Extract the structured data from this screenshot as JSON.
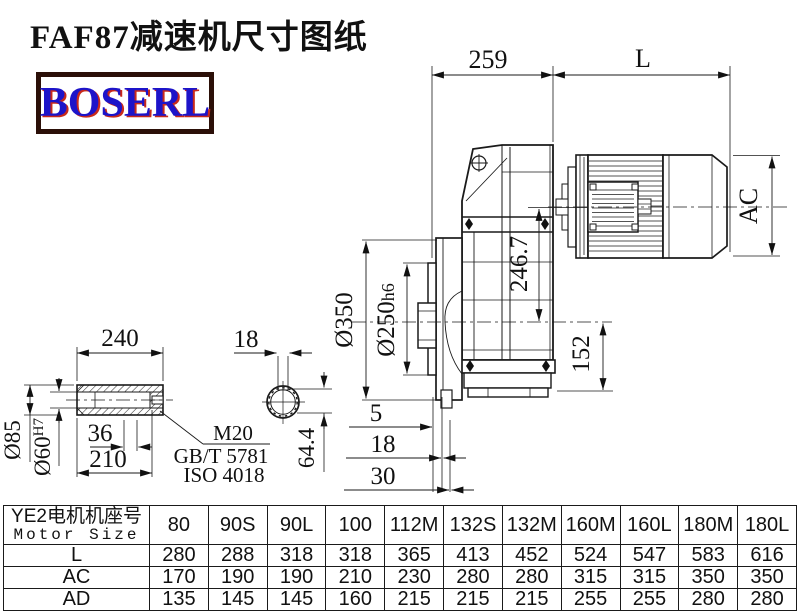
{
  "title": "FAF87减速机尺寸图纸",
  "logo": {
    "text": "BOSERL"
  },
  "drawing": {
    "dims": {
      "top_width": "259",
      "motor_length": "L",
      "motor_diameter": "AC",
      "center_height": "246.7",
      "flange_od": "Ø350",
      "spigot_d": "Ø250",
      "spigot_tol": "h6",
      "below_center": "152",
      "offset_5": "5",
      "offset_18": "18",
      "offset_30": "30",
      "sleeve_length": "240",
      "sleeve_od": "Ø85",
      "bore_d": "Ø60",
      "bore_tol": "H7",
      "bore_36": "36",
      "bore_depth": "210",
      "key_width": "18",
      "key_height": "64.4",
      "thread": "M20",
      "thread_std1": "GB/T 5781",
      "thread_std2": "ISO 4018"
    }
  },
  "table": {
    "header_cn": "YE2电机机座号",
    "header_en": "Motor Size",
    "columns": [
      "80",
      "90S",
      "90L",
      "100",
      "112M",
      "132S",
      "132M",
      "160M",
      "160L",
      "180M",
      "180L"
    ],
    "rows": [
      {
        "label": "L",
        "values": [
          "280",
          "288",
          "318",
          "318",
          "365",
          "413",
          "452",
          "524",
          "547",
          "583",
          "616"
        ]
      },
      {
        "label": "AC",
        "values": [
          "170",
          "190",
          "190",
          "210",
          "230",
          "280",
          "280",
          "315",
          "315",
          "350",
          "350"
        ]
      },
      {
        "label": "AD",
        "values": [
          "135",
          "145",
          "145",
          "160",
          "215",
          "215",
          "215",
          "255",
          "255",
          "280",
          "280"
        ]
      }
    ]
  }
}
